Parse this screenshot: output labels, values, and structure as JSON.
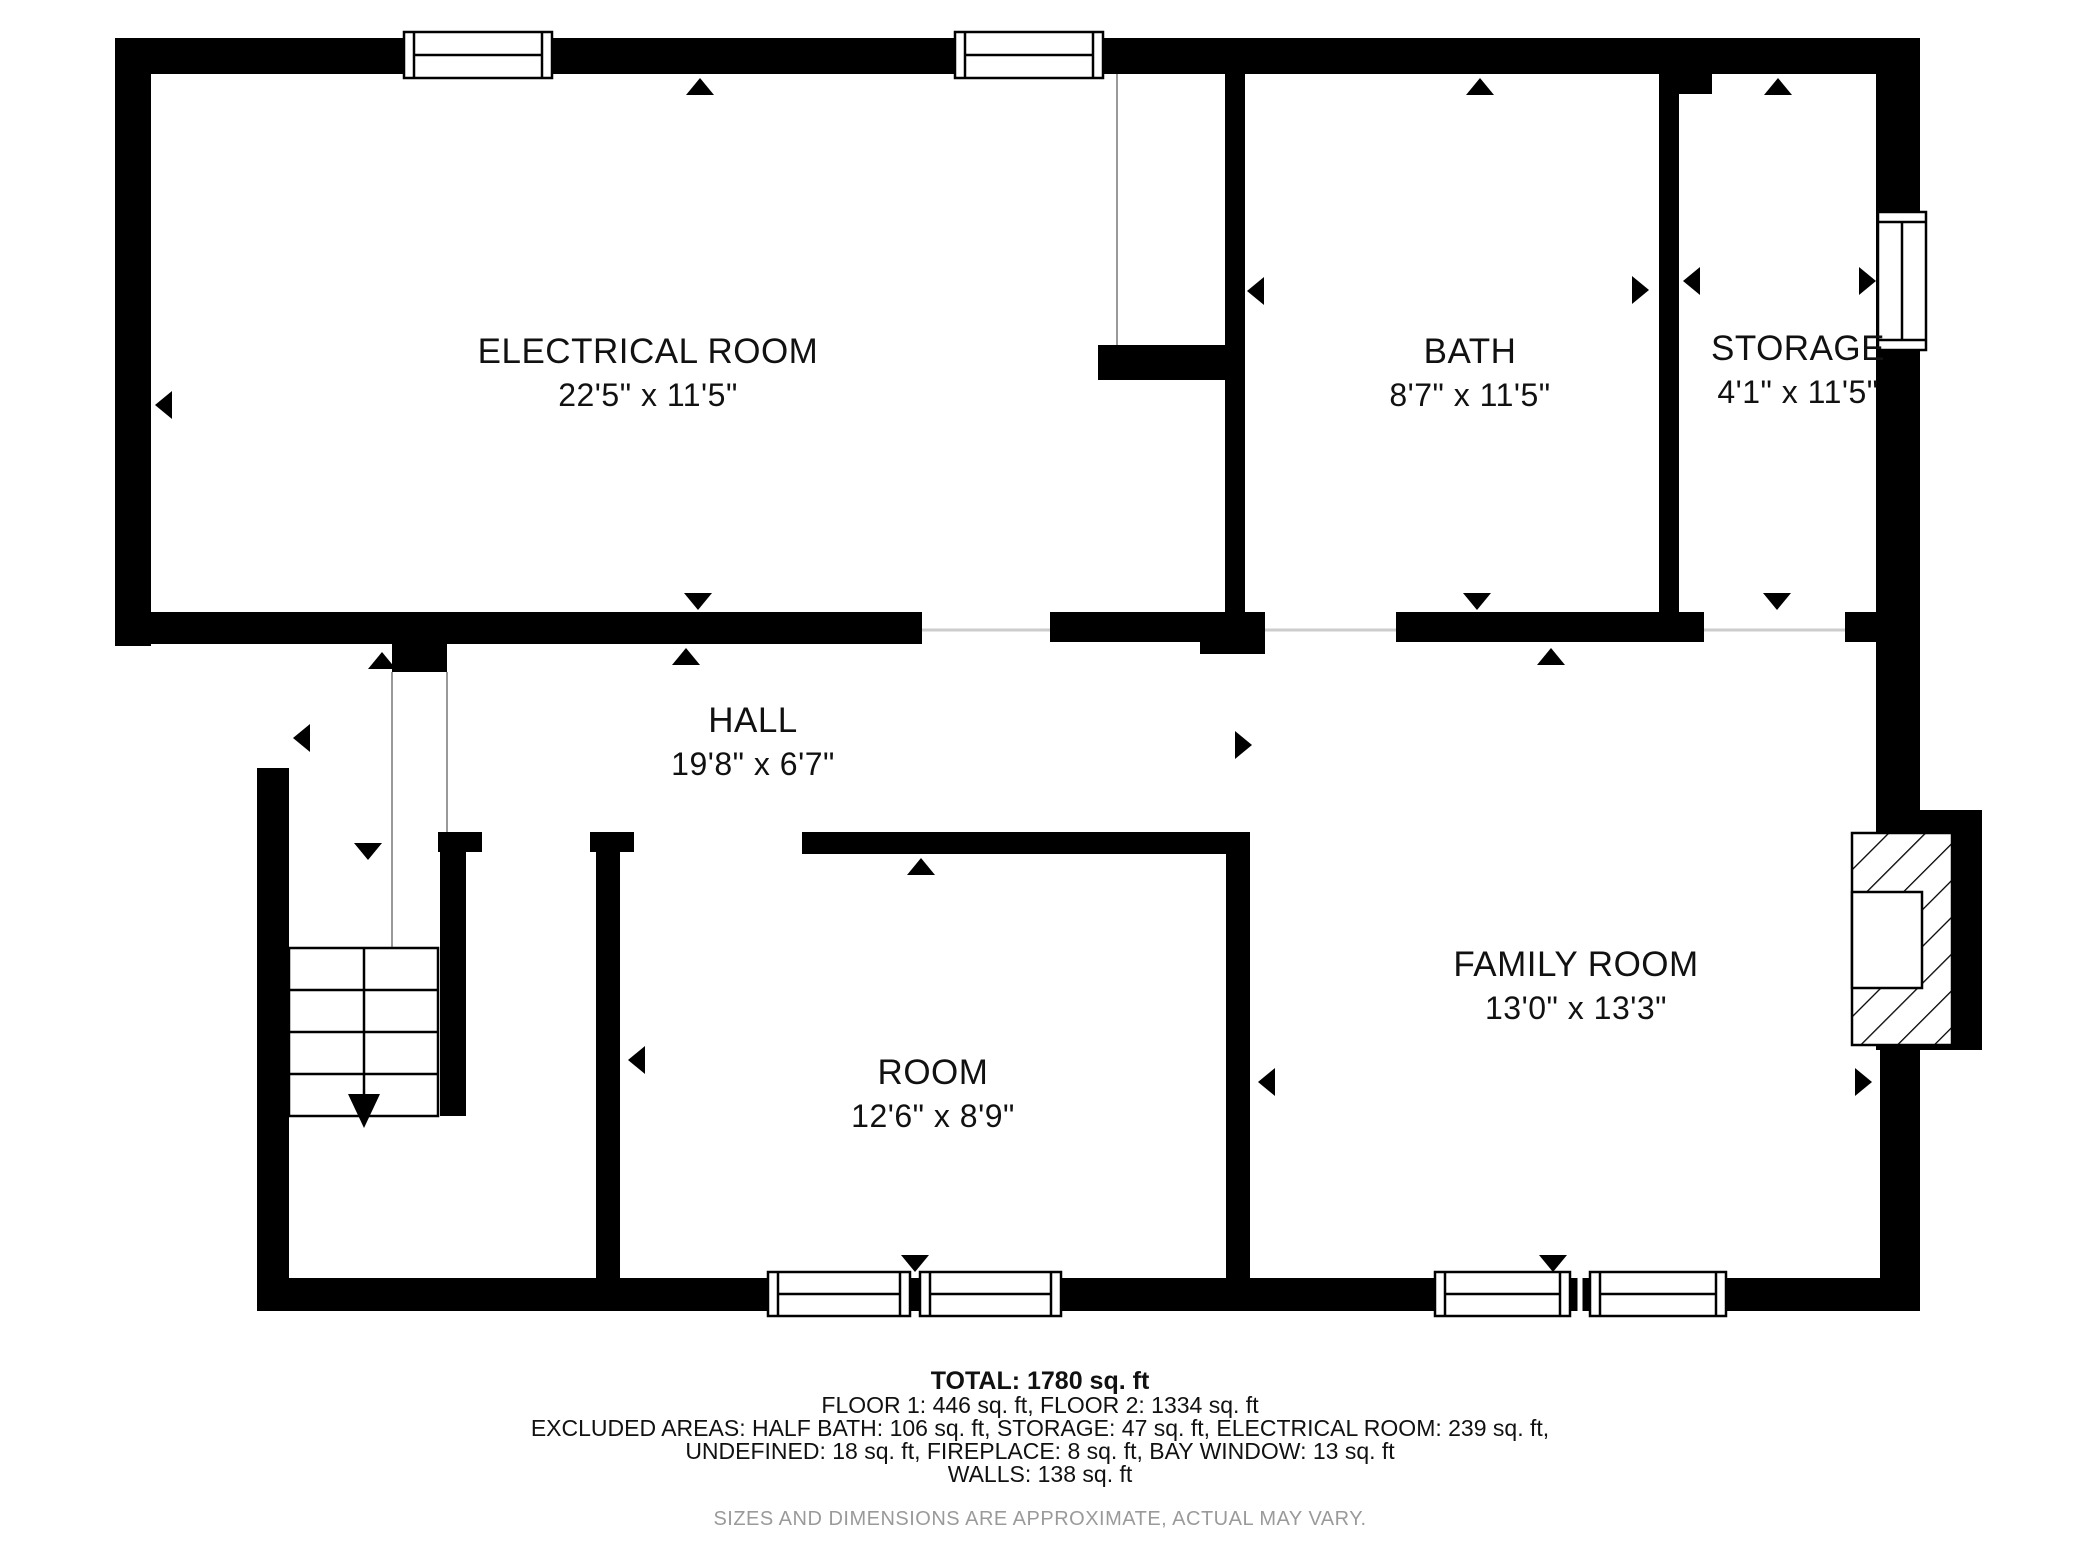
{
  "floorplan": {
    "rooms": [
      {
        "id": "electrical-room",
        "name": "ELECTRICAL ROOM",
        "dims": "22'5\" x 11'5\""
      },
      {
        "id": "bath",
        "name": "BATH",
        "dims": "8'7\" x 11'5\""
      },
      {
        "id": "storage",
        "name": "STORAGE",
        "dims": "4'1\" x 11'5\""
      },
      {
        "id": "hall",
        "name": "HALL",
        "dims": "19'8\" x 6'7\""
      },
      {
        "id": "room",
        "name": "ROOM",
        "dims": "12'6\" x 8'9\""
      },
      {
        "id": "family-room",
        "name": "FAMILY ROOM",
        "dims": "13'0\" x 13'3\""
      }
    ],
    "icons": {
      "door-direction-arrow": "small solid triangle marker",
      "stairs-down-arrow": "long down arrow on stair run",
      "fireplace": "diagonal-hatched box with white firebox",
      "window": "white double-line break in wall"
    }
  },
  "footer": {
    "total": "TOTAL: 1780 sq. ft",
    "floors_line": "FLOOR 1: 446 sq. ft, FLOOR 2: 1334 sq. ft",
    "excluded_line1": "EXCLUDED AREAS: HALF BATH: 106 sq. ft, STORAGE: 47 sq. ft, ELECTRICAL ROOM: 239 sq. ft,",
    "excluded_line2": "UNDEFINED: 18 sq. ft, FIREPLACE: 8 sq. ft, BAY WINDOW: 13 sq. ft",
    "walls_line": "WALLS: 138 sq. ft",
    "disclaimer": "SIZES AND DIMENSIONS ARE APPROXIMATE, ACTUAL MAY VARY."
  },
  "area_summary": {
    "total_sqft": 1780,
    "floor_1_sqft": 446,
    "floor_2_sqft": 1334,
    "excluded_areas": {
      "half_bath_sqft": 106,
      "storage_sqft": 47,
      "electrical_room_sqft": 239,
      "undefined_sqft": 18,
      "fireplace_sqft": 8,
      "bay_window_sqft": 13,
      "walls_sqft": 138
    }
  },
  "colors": {
    "wall": "#000000",
    "label_text": "#111111",
    "footer_text": "#111111",
    "disclaimer_text": "#9a9a9a",
    "background": "#ffffff",
    "thin_line": "#999999",
    "open_boundary": "#cccccc"
  }
}
